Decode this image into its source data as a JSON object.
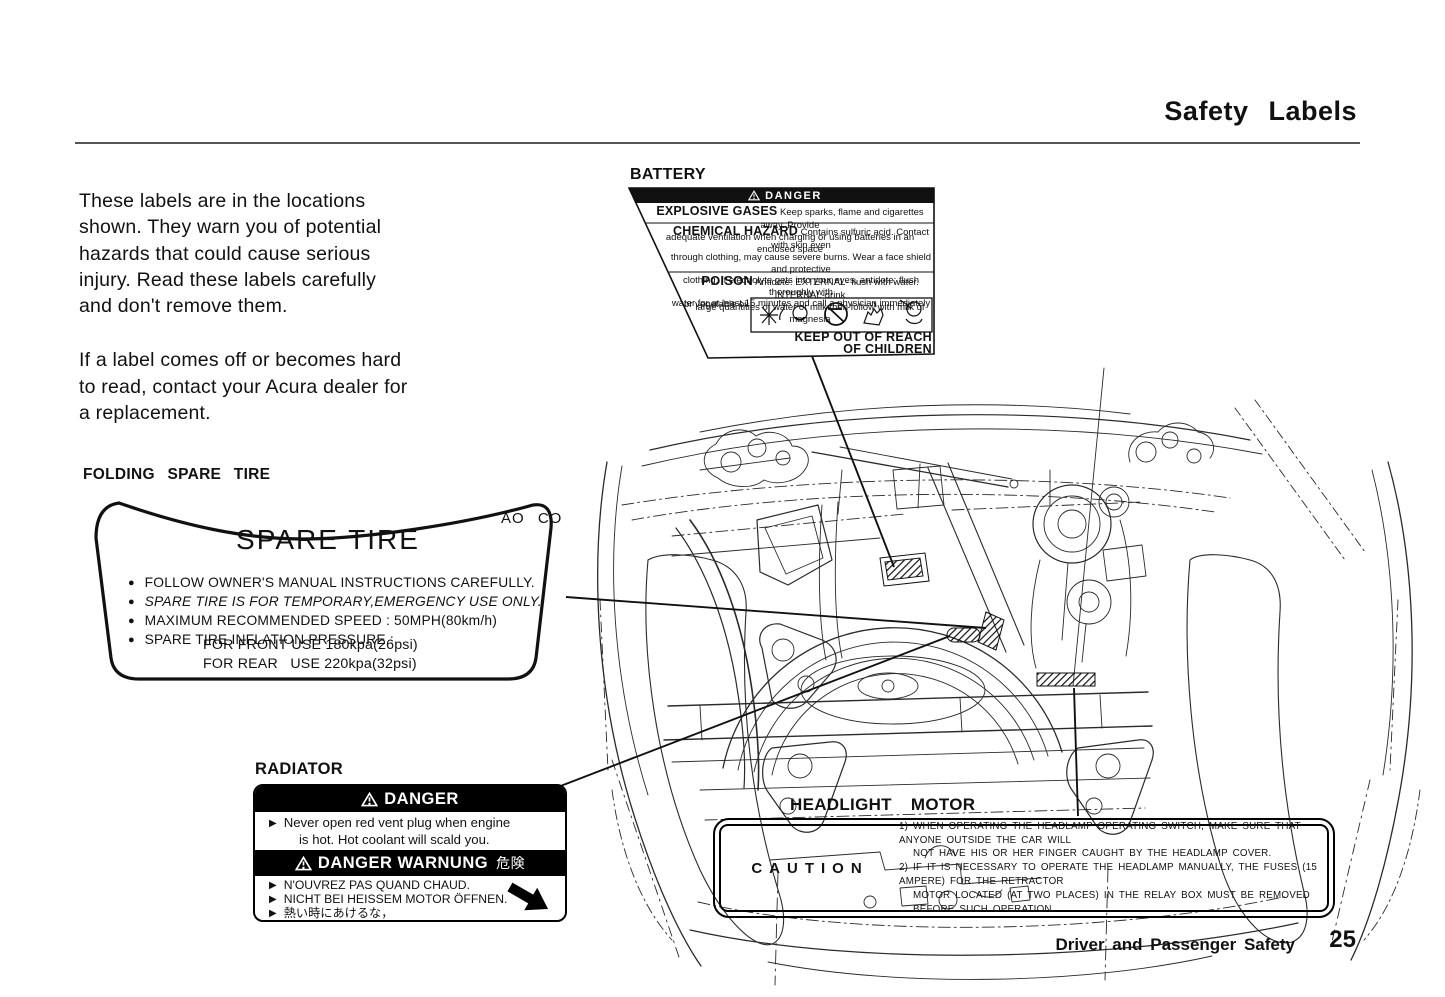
{
  "page": {
    "title": "Safety Labels",
    "footer_section": "Driver and Passenger Safety",
    "footer_page": "25"
  },
  "intro": {
    "para1_lines": [
      "These labels are in the locations",
      "shown. They warn you of potential",
      "hazards that could cause serious",
      "injury. Read these labels carefully",
      "and don't remove them."
    ],
    "para2_lines": [
      "If a label comes off or becomes hard",
      "to read, contact your Acura dealer for",
      "a replacement."
    ]
  },
  "battery": {
    "heading": "BATTERY",
    "danger": "DANGER",
    "explosive_title": "EXPLOSIVE GASES",
    "explosive_line1": "Keep sparks, flame and cigarettes away. Provide",
    "explosive_line2": "adequate ventilation when charging or using batteries in an enclosed space",
    "chemical_title": "CHEMICAL HAZARD",
    "chemical_line1": "Contains sulfuric acid. Contact with skin even",
    "chemical_line2": "through clothing, may cause severe burns. Wear a face shield and protective",
    "chemical_line3": "clothing. If electrolyte gets into your eyes, antidote: flush thoroughly with",
    "chemical_line4": "water for at least 15 minutes and call a physician immediately",
    "poison_title": "POISON",
    "poison_line1": "Antidote: EXTERNAL- flush with water. INTERNAL-drink",
    "poison_line2": "large quantities of water or milk then follow with milk of magnesia",
    "poison_line3": "or vegetable oil",
    "keep_out_line1": "KEEP OUT OF REACH",
    "keep_out_line2": "OF CHILDREN"
  },
  "spare": {
    "heading": "FOLDING SPARE TIRE",
    "corner_mark": "AO CO",
    "title": "SPARE TIRE",
    "bullet_char": "●",
    "bullets": [
      "FOLLOW OWNER'S MANUAL INSTRUCTIONS CAREFULLY.",
      "SPARE TIRE IS FOR TEMPORARY,EMERGENCY USE ONLY.",
      "MAXIMUM RECOMMENDED SPEED : 50MPH(80km/h)",
      "SPARE TIRE INFLATION PRESSURE :"
    ],
    "pressure_front": "FOR FRONT USE 180kpa(26psi)",
    "pressure_rear": "FOR REAR   USE 220kpa(32psi)"
  },
  "radiator": {
    "heading": "RADIATOR",
    "danger": "DANGER",
    "bullet_char": "▶",
    "en_line1": "Never open red vent plug when engine",
    "en_line2": "is hot. Hot coolant will scald you.",
    "warnung": "DANGER WARNUNG",
    "warnung_kanji": "危険",
    "fr_line": "N'OUVREZ PAS QUAND CHAUD.",
    "de_line": "NICHT BEI HEISSEM MOTOR ÖFFNEN.",
    "ja_line": "熱い時にあけるな，"
  },
  "headlight": {
    "heading": "HEADLIGHT MOTOR",
    "caution": "CAUTION",
    "line1": "1) WHEN OPERATING THE HEADLAMP OPERATING SWITCH, MAKE SURE THAT ANYONE OUTSIDE THE CAR WILL",
    "line2": "NOT HAVE HIS OR HER FINGER CAUGHT BY THE HEADLAMP COVER.",
    "line3": "2) IF IT IS NECESSARY TO OPERATE THE HEADLAMP MANUALLY, THE FUSES (15 AMPERE) FOR THE RETRACTOR",
    "line4": "MOTOR LOCATED (AT TWO PLACES) IN THE RELAY BOX MUST BE REMOVED BEFORE SUCH OPERATION"
  }
}
